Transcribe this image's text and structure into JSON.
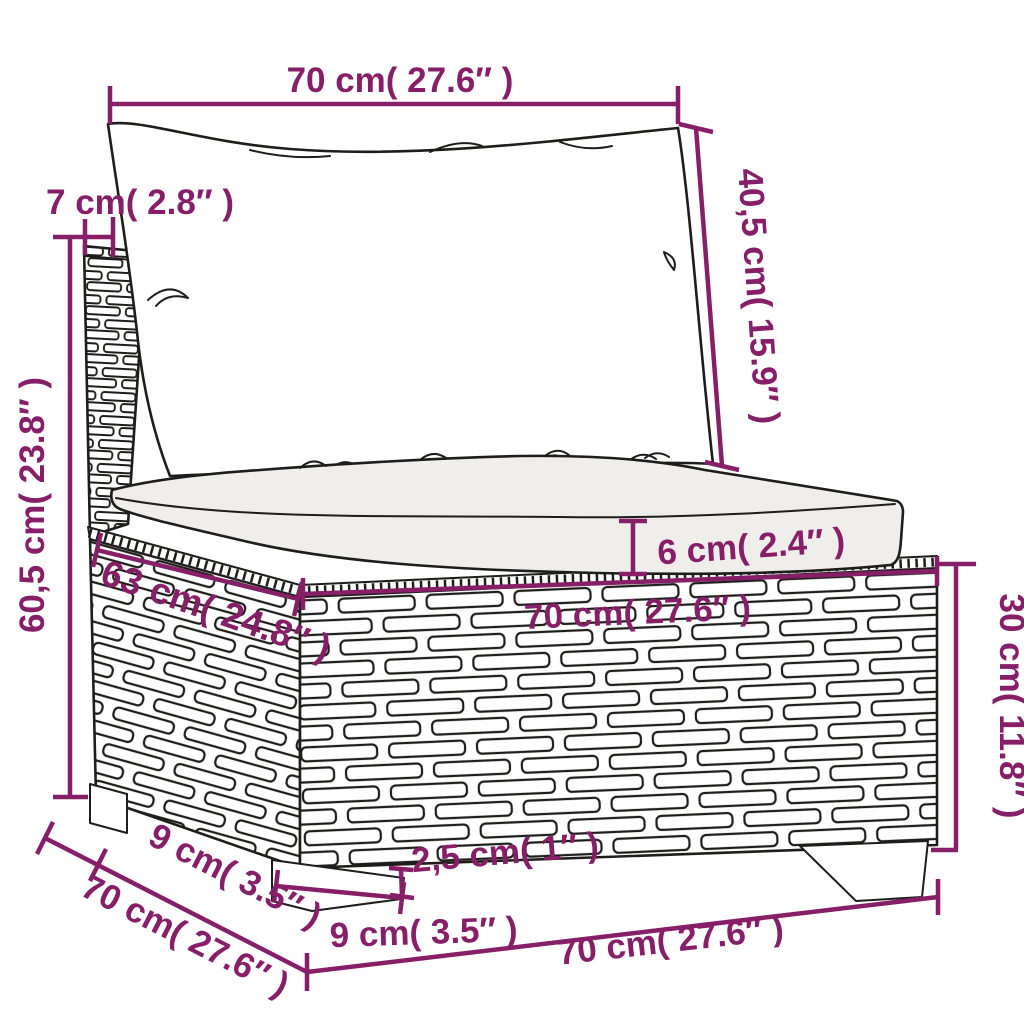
{
  "diagram": {
    "product": "rattan garden sofa middle section with cushions",
    "style": {
      "accent_color": "#861f68",
      "line_color": "#1d1d1b",
      "cushion_fill": "#efeeea",
      "background": "#ffffff"
    },
    "dimensions": {
      "top_width": "70 cm( 27.6″ )",
      "post_depth": "7 cm( 2.8″ )",
      "back_cushion_height": "40,5 cm( 15.9″ )",
      "total_height": "60,5 cm( 23.8″ )",
      "cushion_thickness": "6 cm( 2.4″ )",
      "seat_depth": "63 cm( 24.8″ )",
      "seat_width": "70 cm( 27.6″ )",
      "base_height": "30 cm( 11.8″ )",
      "leg_inset": "9 cm( 3.5″ )",
      "total_depth": "70 cm( 27.6″ )",
      "leg_width": "9 cm( 3.5″ )",
      "leg_height": "2,5 cm( 1″ )",
      "total_width": "70 cm( 27.6″ )"
    }
  }
}
